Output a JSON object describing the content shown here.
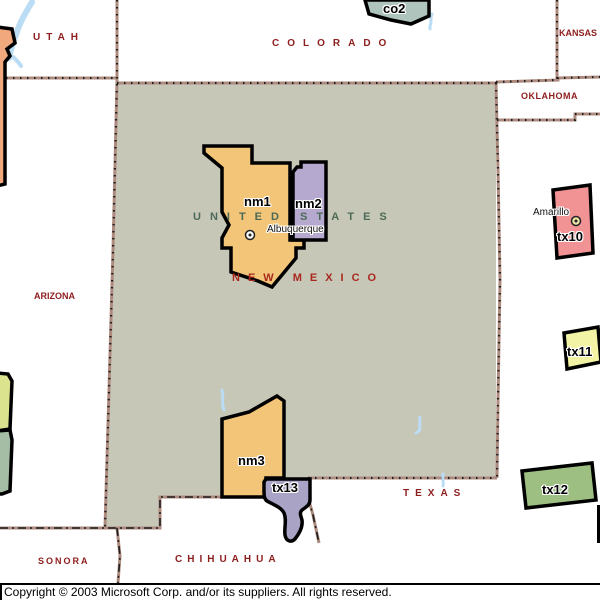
{
  "labels": {
    "country": "UNITED STATES",
    "new_mexico": "NEW MEXICO",
    "states": {
      "utah": "UTAH",
      "colorado": "COLORADO",
      "kansas": "KANSAS",
      "oklahoma": "OKLAHOMA",
      "arizona": "ARIZONA",
      "texas": "TEXAS",
      "sonora": "SONORA",
      "chihuahua": "CHIHUAHUA"
    }
  },
  "districts": {
    "co2": {
      "label": "co2",
      "color": "#afc4bd"
    },
    "nm1": {
      "label": "nm1",
      "color": "#f2c579"
    },
    "nm2": {
      "label": "nm2",
      "color": "#b6a9cf"
    },
    "nm3": {
      "label": "nm3",
      "color": "#f2c579"
    },
    "tx10": {
      "label": "tx10",
      "color": "#f19295"
    },
    "tx11": {
      "label": "tx11",
      "color": "#f3f3a5"
    },
    "tx12": {
      "label": "tx12",
      "color": "#9dbf82"
    },
    "tx13": {
      "label": "tx13",
      "color": "#a9a3c6"
    }
  },
  "edge_shapes": {
    "west_salmon": {
      "color": "#f2a87d"
    },
    "west_yellowgreen": {
      "color": "#dce38f"
    },
    "west_sage": {
      "color": "#a5bda4"
    }
  },
  "cities": {
    "albuquerque": {
      "label": "Albuquerque"
    },
    "amarillo": {
      "label": "Amarillo"
    }
  },
  "map_colors": {
    "selected_state_fill": "#c7c7b8",
    "background": "#ffffff",
    "water": "#bbdcf5",
    "state_border": "#ae8b7f",
    "state_label": "#8e1d1d",
    "country_label": "#4c6a57"
  },
  "footer": {
    "copyright": "Copyright © 2003 Microsoft Corp. and/or its suppliers. All rights reserved."
  }
}
